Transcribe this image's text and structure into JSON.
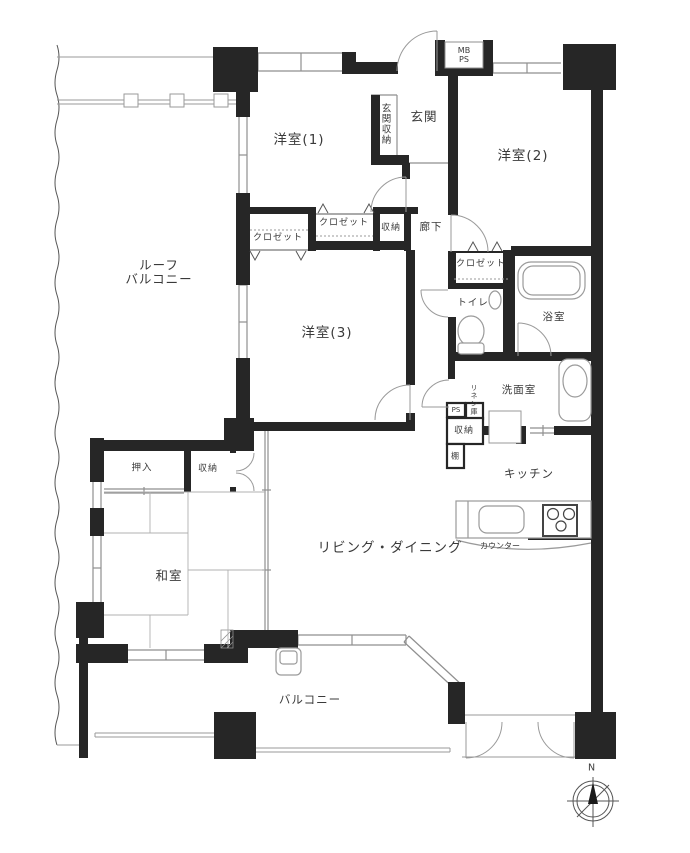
{
  "colors": {
    "wall": "#262626",
    "line": "#8f8f8f",
    "fixture": "#9a9a9a",
    "text": "#3a3a3a"
  },
  "labels": {
    "roof_balcony": "ルーフ\nバルコニー",
    "western_room_1": "洋室(1)",
    "western_room_2": "洋室(2)",
    "western_room_3": "洋室(3)",
    "entrance": "玄関",
    "entrance_storage": "玄関収納",
    "meter_box": "MB\nPS",
    "closet_room1": "クロゼット",
    "closet_room3": "クロゼット",
    "closet_room2": "クロゼット",
    "hall_storage": "収納",
    "hallway": "廊下",
    "toilet": "トイレ",
    "bathroom": "浴室",
    "washroom": "洗面室",
    "linen_closet": "リネン庫",
    "pipe_space": "PS",
    "washroom_storage": "収納",
    "shelf": "棚",
    "kitchen": "キッチン",
    "counter": "カウンター",
    "oshiire": "押入",
    "japanese_room_storage": "収納",
    "japanese_room": "和室",
    "living_dining": "リビング・ダイニング",
    "balcony": "バルコニー",
    "compass_north": "N"
  }
}
